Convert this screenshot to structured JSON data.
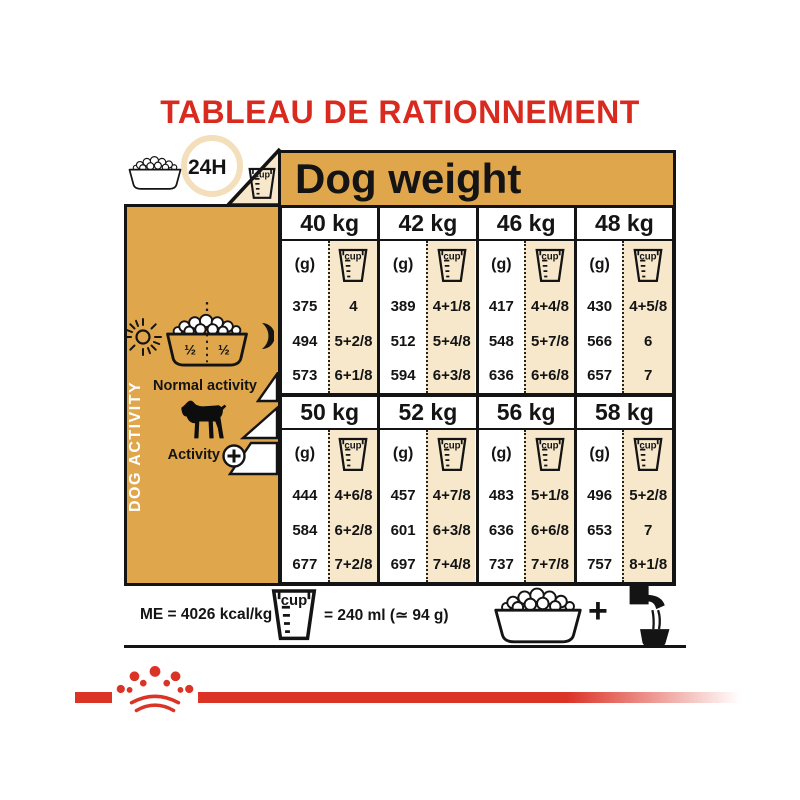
{
  "title": "TABLEAU DE RATIONNEMENT",
  "ration_header": {
    "daily_label": "24H",
    "dog_weight_label": "Dog weight"
  },
  "sidebar": {
    "vertical_label": "DOG ACTIVITY",
    "bowl_half_left": "½",
    "bowl_half_right": "½",
    "normal_activity_label": "Normal activity",
    "activity_label": "Activity",
    "activity_plus_symbol": "+"
  },
  "table": {
    "grams_unit_label": "(g)",
    "cup_unit_label": "cup",
    "groups": [
      {
        "columns": [
          {
            "weight": "40 kg",
            "rows": [
              {
                "g": "375",
                "cups": "4"
              },
              {
                "g": "494",
                "cups": "5+2/8"
              },
              {
                "g": "573",
                "cups": "6+1/8"
              }
            ]
          },
          {
            "weight": "42 kg",
            "rows": [
              {
                "g": "389",
                "cups": "4+1/8"
              },
              {
                "g": "512",
                "cups": "5+4/8"
              },
              {
                "g": "594",
                "cups": "6+3/8"
              }
            ]
          },
          {
            "weight": "46 kg",
            "rows": [
              {
                "g": "417",
                "cups": "4+4/8"
              },
              {
                "g": "548",
                "cups": "5+7/8"
              },
              {
                "g": "636",
                "cups": "6+6/8"
              }
            ]
          },
          {
            "weight": "48 kg",
            "rows": [
              {
                "g": "430",
                "cups": "4+5/8"
              },
              {
                "g": "566",
                "cups": "6"
              },
              {
                "g": "657",
                "cups": "7"
              }
            ]
          }
        ]
      },
      {
        "columns": [
          {
            "weight": "50 kg",
            "rows": [
              {
                "g": "444",
                "cups": "4+6/8"
              },
              {
                "g": "584",
                "cups": "6+2/8"
              },
              {
                "g": "677",
                "cups": "7+2/8"
              }
            ]
          },
          {
            "weight": "52 kg",
            "rows": [
              {
                "g": "457",
                "cups": "4+7/8"
              },
              {
                "g": "601",
                "cups": "6+3/8"
              },
              {
                "g": "697",
                "cups": "7+4/8"
              }
            ]
          },
          {
            "weight": "56 kg",
            "rows": [
              {
                "g": "483",
                "cups": "5+1/8"
              },
              {
                "g": "636",
                "cups": "6+6/8"
              },
              {
                "g": "737",
                "cups": "7+7/8"
              }
            ]
          },
          {
            "weight": "58 kg",
            "rows": [
              {
                "g": "496",
                "cups": "5+2/8"
              },
              {
                "g": "653",
                "cups": "7"
              },
              {
                "g": "757",
                "cups": "8+1/8"
              }
            ]
          }
        ]
      }
    ]
  },
  "footer": {
    "energy_label": "ME = 4026 kcal/kg",
    "cup_equivalence": "= 240 ml (≃ 94 g)",
    "plus_symbol": "+"
  },
  "icons": {
    "food-bowl-icon": "bowl-of-kibble-outline",
    "measuring-cup-icon": "beaker-with-cup-label",
    "sun-icon": "☀",
    "moon-icon": "☾",
    "dog-icon": "rottweiler-silhouette",
    "activity-plus-icon": "⊕",
    "water-tap-icon": "faucet-pouring-into-bowl",
    "crown-icon": "royal-canin-crown"
  },
  "colors": {
    "brand_red": "#D92A20",
    "gold": "#DFA64C",
    "cream": "#F7E8CC"
  }
}
